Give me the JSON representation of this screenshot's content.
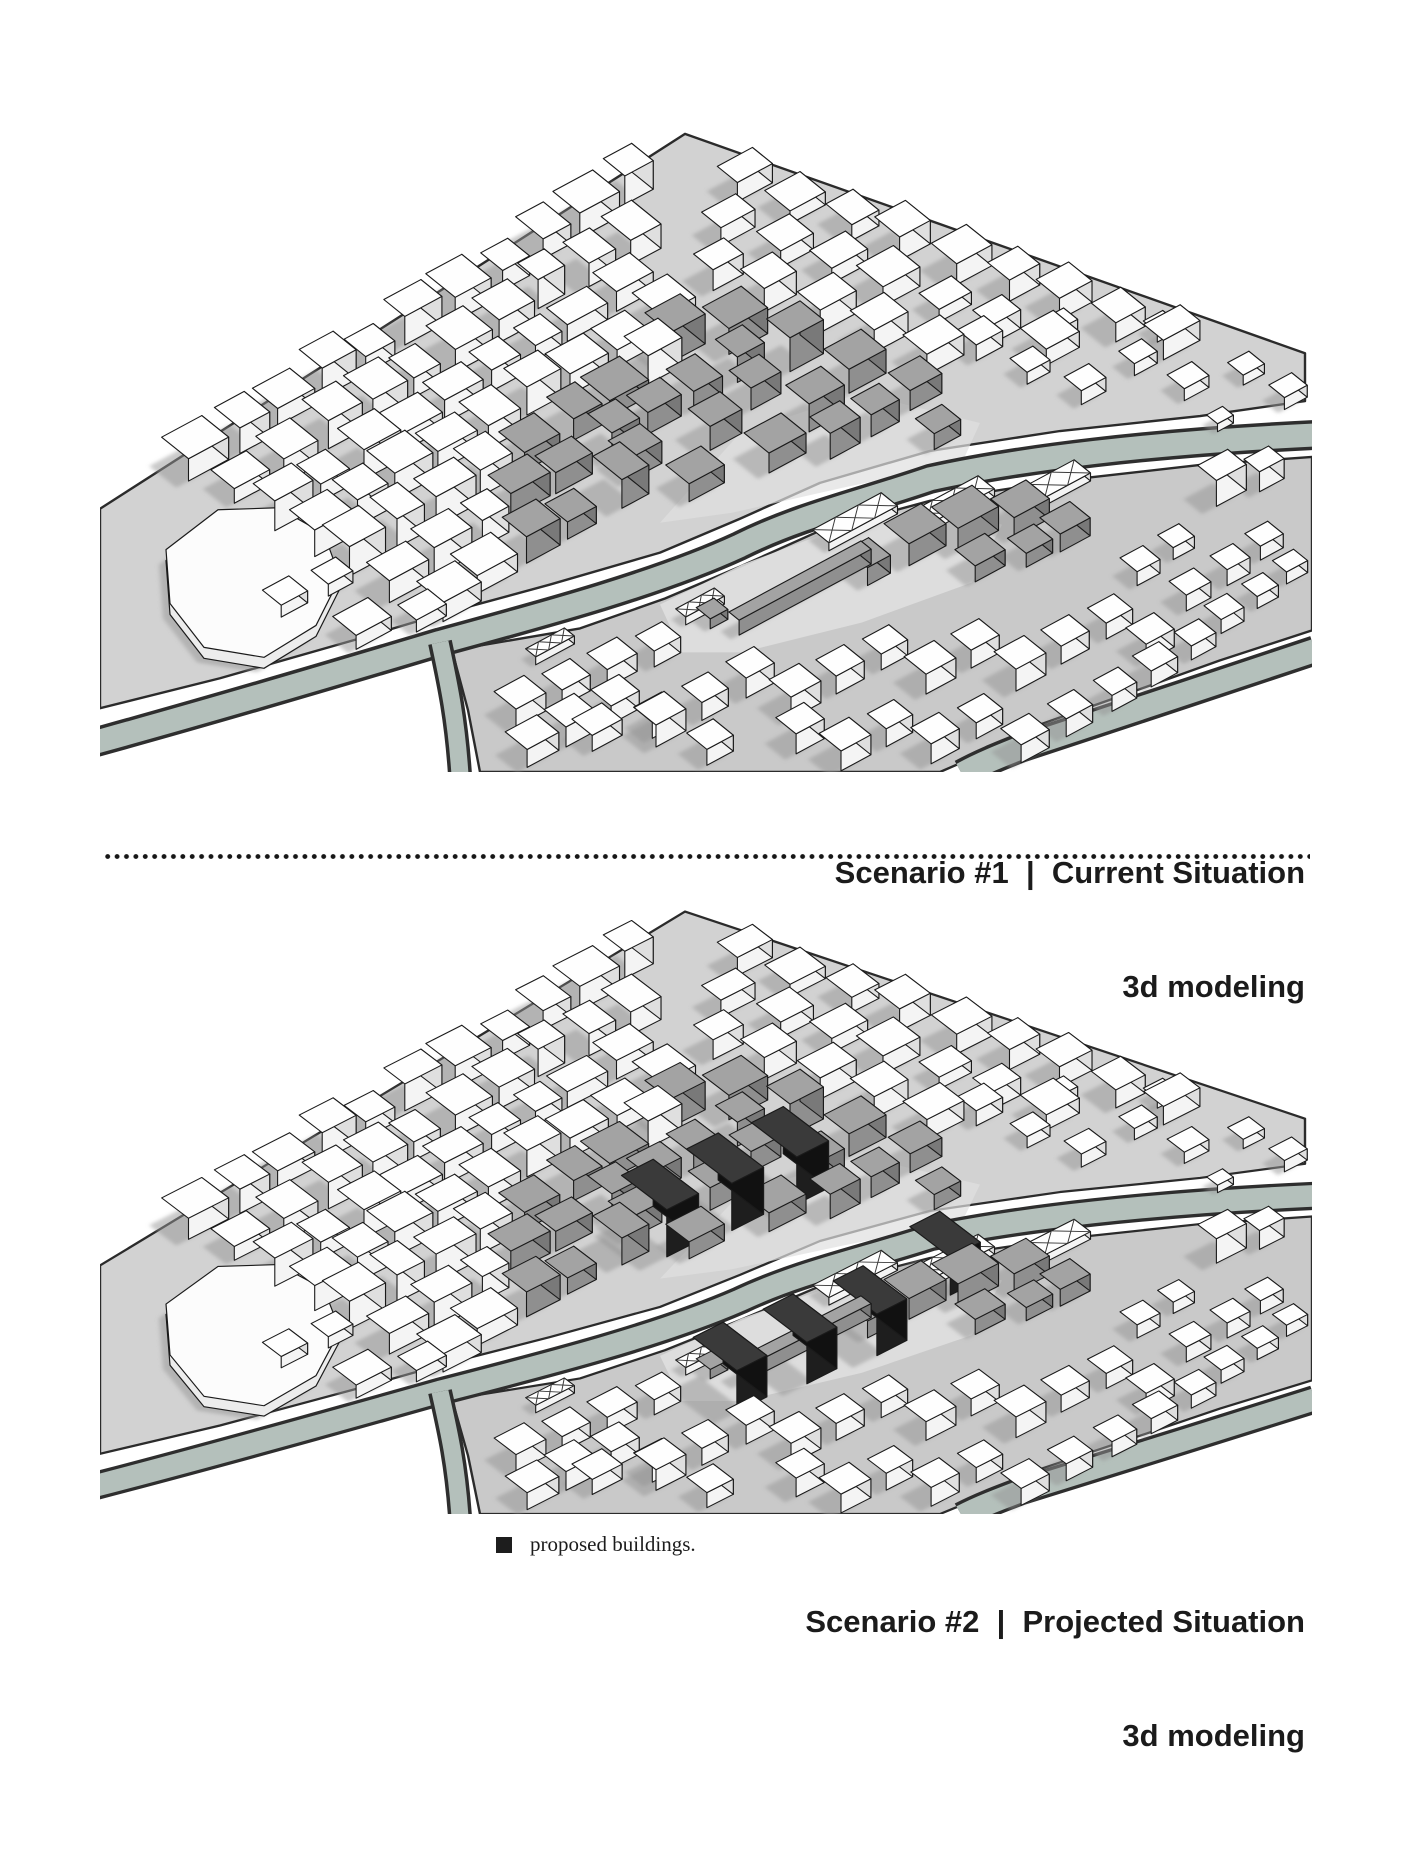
{
  "figures": {
    "scenario1": {
      "caption_title": "Scenario #1  |  Current Situation",
      "caption_subtitle": "3d modeling"
    },
    "scenario2": {
      "caption_title": "Scenario #2  |  Projected Situation",
      "caption_subtitle": "3d modeling",
      "legend_label": "proposed buildings."
    }
  },
  "colors": {
    "page_background": "#ffffff",
    "caption_text": "#1b1b1b",
    "water": "#b4c0bb",
    "water_edge": "#2e2e2e",
    "ground_main": "#d2d2d2",
    "ground_island": "#c9c9c9",
    "ground_plaza": "#dfdfdf",
    "ground_edge": "#2b2b2b",
    "building_white": "#ffffff",
    "building_gray": "#9b9b9b",
    "building_proposed": "#1d1d1d",
    "outline": "#1a1a1a",
    "shadow": "#949494"
  }
}
